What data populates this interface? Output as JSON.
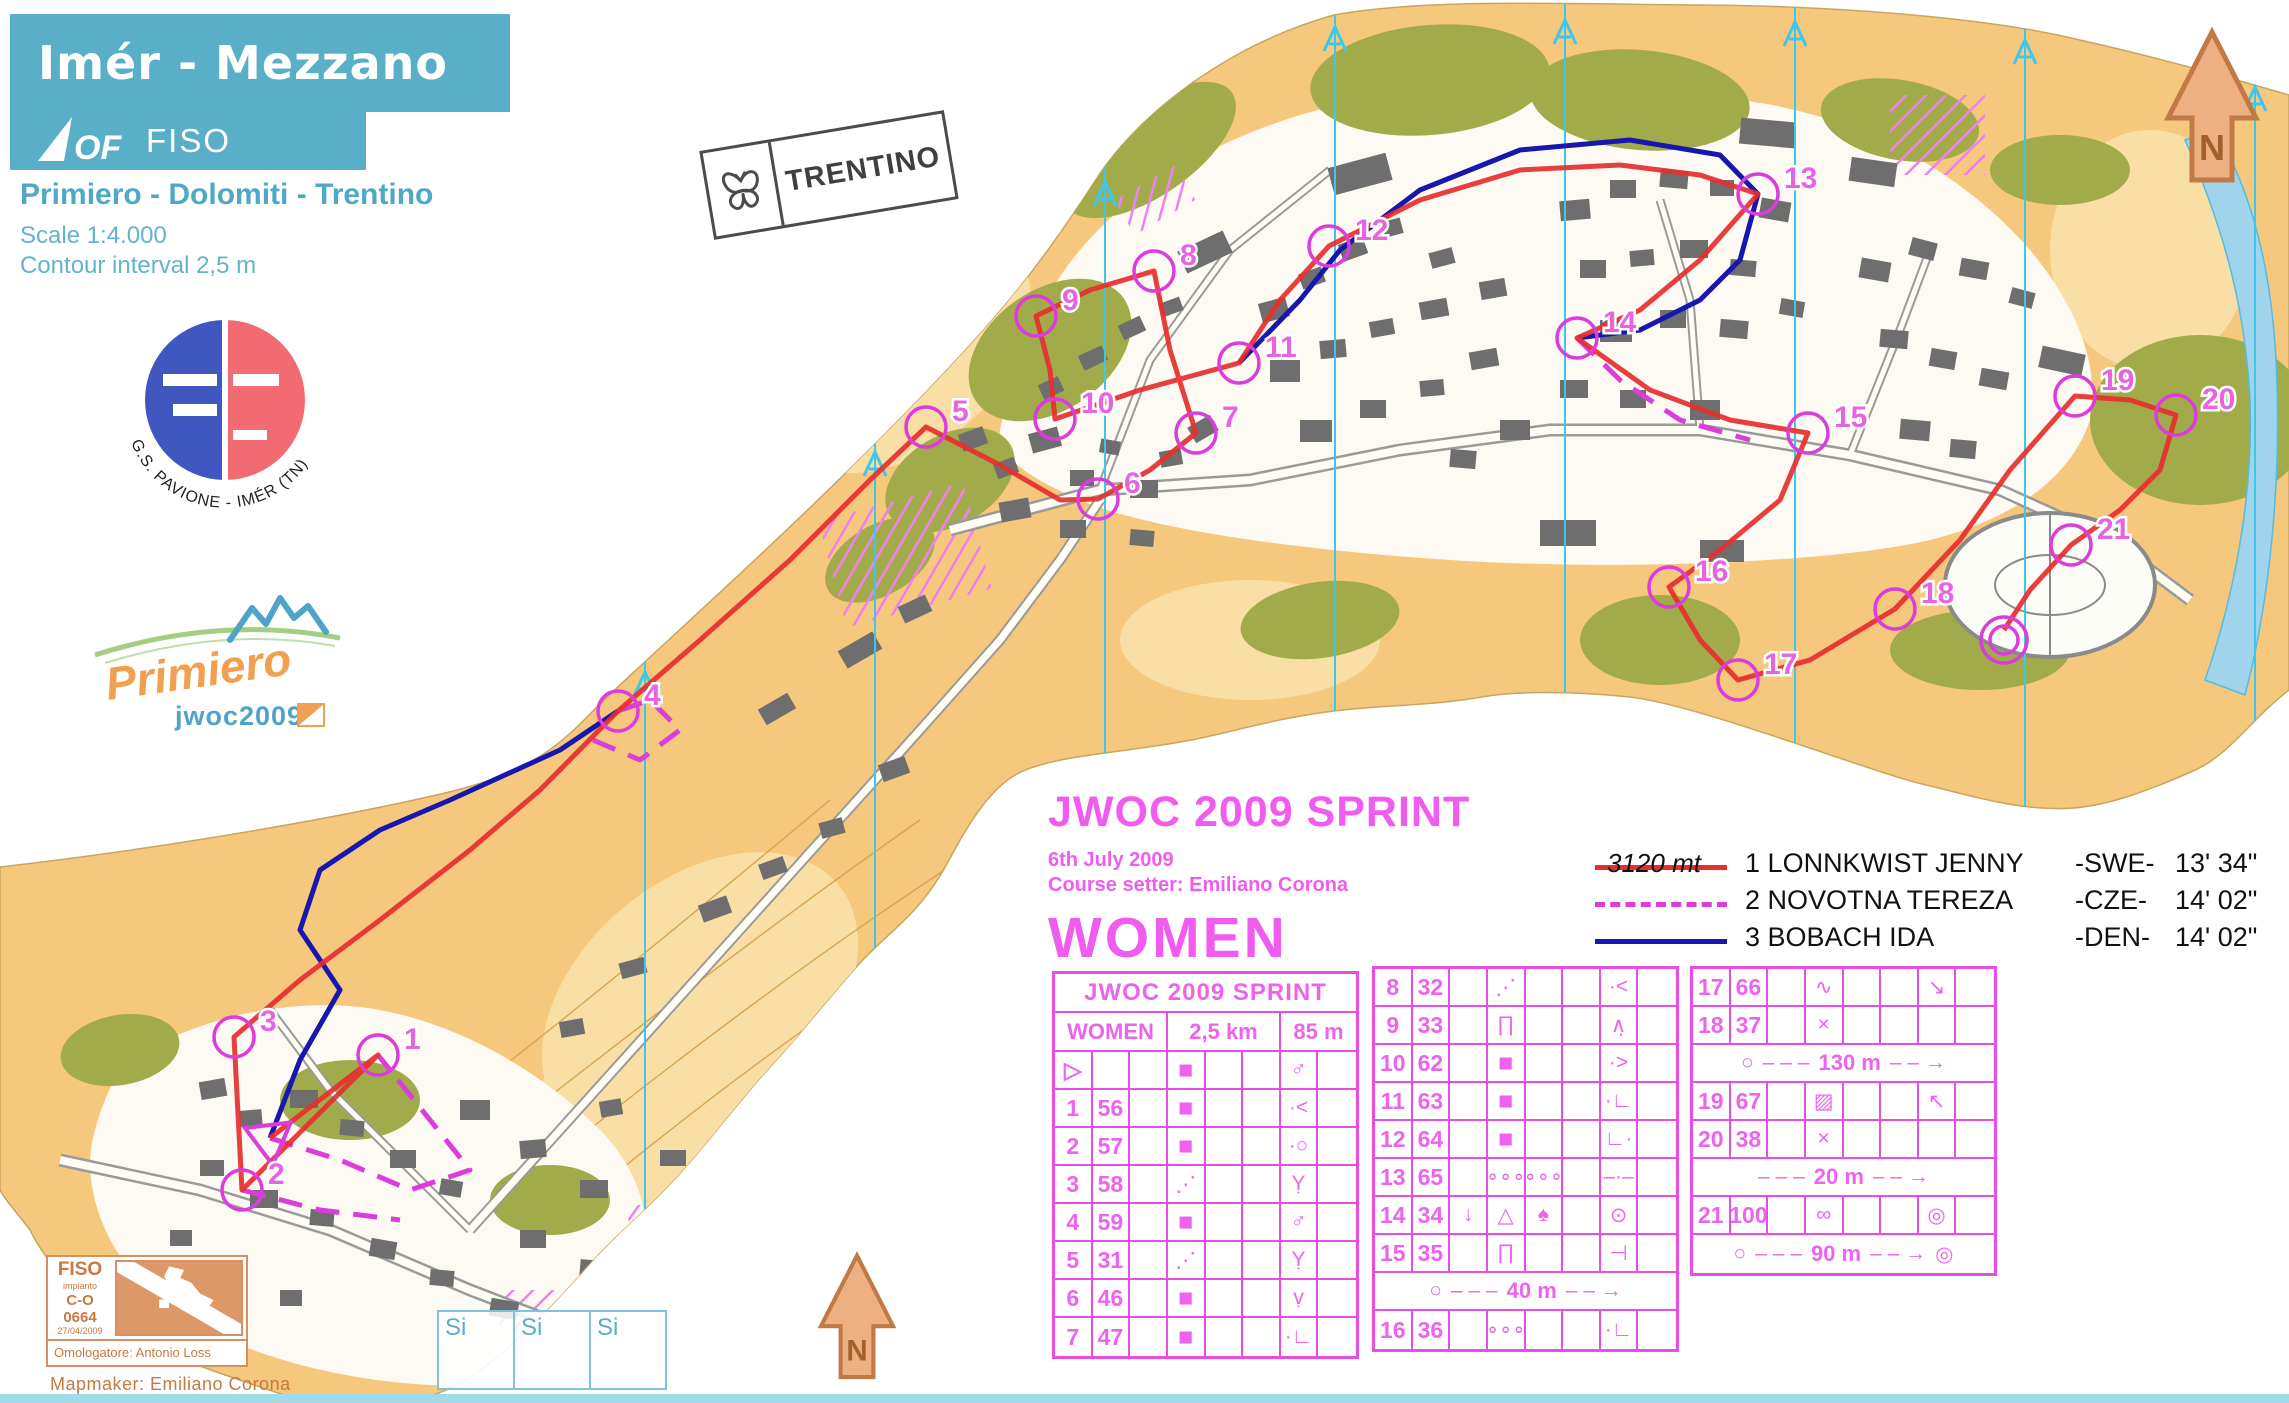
{
  "colors": {
    "header_teal": "#58AFC7",
    "event_pink": "#F05CF0",
    "card_magenta": "#E84DE8",
    "route_red": "#E62E2E",
    "route_magenta_dashed": "#DC3CDC",
    "route_blue": "#1717AE",
    "terrain_orange": "#F5C87D",
    "fiso_tan": "#C9783F"
  },
  "title_block": {
    "title": "Imér - Mezzano",
    "iof_text": "OF",
    "fiso_text": "FISO",
    "subtitle": "Primiero - Dolomiti - Trentino",
    "scale": "Scale 1:4.000",
    "contour": "Contour interval 2,5 m"
  },
  "logos": {
    "club_arc_text": "G.S. PAVIONE - IMÉR (TN)",
    "primiero_script": "Primiero",
    "jwoc_text": "jwoc2009",
    "trentino_text": "TRENTINO"
  },
  "event_block": {
    "title": "JWOC 2009 SPRINT",
    "date": "6th July 2009",
    "setter": "Course setter: Emiliano Corona",
    "category": "WOMEN"
  },
  "legend": {
    "distance": "3120 mt",
    "entries": [
      {
        "rank": "1",
        "name": "LONNKWIST JENNY",
        "country": "-SWE-",
        "time": "13' 34\""
      },
      {
        "rank": "2",
        "name": "NOVOTNA TEREZA",
        "country": "-CZE-",
        "time": "14' 02\""
      },
      {
        "rank": "3",
        "name": "BOBACH IDA",
        "country": "-DEN-",
        "time": "14' 02\""
      }
    ]
  },
  "control_card": {
    "title": "JWOC 2009 SPRINT",
    "header": {
      "category": "WOMEN",
      "length": "2,5 km",
      "climb": "85 m"
    },
    "panel1": [
      {
        "n": "▷",
        "code": "",
        "s": [
          "",
          "■",
          "",
          "",
          "♂",
          ""
        ]
      },
      {
        "n": "1",
        "code": "56",
        "s": [
          "",
          "■",
          "",
          "",
          "·<",
          ""
        ]
      },
      {
        "n": "2",
        "code": "57",
        "s": [
          "",
          "■",
          "",
          "",
          "·○",
          ""
        ]
      },
      {
        "n": "3",
        "code": "58",
        "s": [
          "",
          "⋰",
          "",
          "",
          "Ỵ",
          ""
        ]
      },
      {
        "n": "4",
        "code": "59",
        "s": [
          "",
          "■",
          "",
          "",
          "♂",
          ""
        ]
      },
      {
        "n": "5",
        "code": "31",
        "s": [
          "",
          "⋰",
          "",
          "",
          "Ỵ",
          ""
        ]
      },
      {
        "n": "6",
        "code": "46",
        "s": [
          "",
          "■",
          "",
          "",
          "ṿ",
          ""
        ]
      },
      {
        "n": "7",
        "code": "47",
        "s": [
          "",
          "■",
          "",
          "",
          "·∟",
          ""
        ]
      }
    ],
    "panel2": [
      {
        "n": "8",
        "code": "32",
        "s": [
          "",
          "⋰",
          "",
          "",
          "·<",
          ""
        ]
      },
      {
        "n": "9",
        "code": "33",
        "s": [
          "",
          "∏",
          "",
          "",
          "∧̣",
          ""
        ]
      },
      {
        "n": "10",
        "code": "62",
        "s": [
          "",
          "■",
          "",
          "",
          "·>",
          ""
        ]
      },
      {
        "n": "11",
        "code": "63",
        "s": [
          "",
          "■",
          "",
          "",
          "·∟",
          ""
        ]
      },
      {
        "n": "12",
        "code": "64",
        "s": [
          "",
          "■",
          "",
          "",
          "∟·",
          ""
        ]
      },
      {
        "n": "13",
        "code": "65",
        "s": [
          "",
          "∘∘∘",
          "∘∘∘",
          "",
          "–·–",
          ""
        ]
      },
      {
        "n": "14",
        "code": "34",
        "s": [
          "↓",
          "△",
          "♠",
          "",
          "⊙",
          ""
        ]
      },
      {
        "n": "15",
        "code": "35",
        "s": [
          "",
          "∏",
          "",
          "",
          "⊣",
          ""
        ]
      },
      {
        "special": true,
        "circle": true,
        "label": "40 m",
        "finish": false
      },
      {
        "n": "16",
        "code": "36",
        "s": [
          "",
          "∘∘∘",
          "",
          "",
          "·∟",
          ""
        ]
      }
    ],
    "panel3": [
      {
        "n": "17",
        "code": "66",
        "s": [
          "",
          "∿",
          "",
          "",
          "↘",
          ""
        ]
      },
      {
        "n": "18",
        "code": "37",
        "s": [
          "",
          "×",
          "",
          "",
          "",
          ""
        ]
      },
      {
        "special": true,
        "circle": true,
        "label": "130 m",
        "finish": false
      },
      {
        "n": "19",
        "code": "67",
        "s": [
          "",
          "▨",
          "",
          "",
          "↖",
          ""
        ]
      },
      {
        "n": "20",
        "code": "38",
        "s": [
          "",
          "×",
          "",
          "",
          "",
          ""
        ]
      },
      {
        "special": true,
        "circle": false,
        "label": "20 m",
        "finish": false
      },
      {
        "n": "21",
        "code": "100",
        "s": [
          "",
          "∞",
          "",
          "",
          "◎",
          ""
        ]
      },
      {
        "special": true,
        "circle": true,
        "label": "90 m",
        "finish": true
      }
    ]
  },
  "fiso_box": {
    "name": "FISO",
    "sub": "impianto",
    "code": "C-O",
    "number": "0664",
    "date": "27/04/2009",
    "approver": "Omologatore: Antonio Loss"
  },
  "mapmaker": "Mapmaker: Emiliano Corona",
  "si_boxes": [
    "Si",
    "Si",
    "Si"
  ],
  "north_label": "N",
  "map": {
    "controls": [
      {
        "n": "1",
        "x": 378,
        "y": 1055
      },
      {
        "n": "2",
        "x": 242,
        "y": 1190
      },
      {
        "n": "3",
        "x": 234,
        "y": 1037
      },
      {
        "n": "4",
        "x": 618,
        "y": 711
      },
      {
        "n": "5",
        "x": 926,
        "y": 427
      },
      {
        "n": "6",
        "x": 1098,
        "y": 499
      },
      {
        "n": "7",
        "x": 1196,
        "y": 433
      },
      {
        "n": "8",
        "x": 1154,
        "y": 271
      },
      {
        "n": "9",
        "x": 1036,
        "y": 316
      },
      {
        "n": "10",
        "x": 1055,
        "y": 419
      },
      {
        "n": "11",
        "x": 1239,
        "y": 363
      },
      {
        "n": "12",
        "x": 1329,
        "y": 246
      },
      {
        "n": "13",
        "x": 1758,
        "y": 194
      },
      {
        "n": "14",
        "x": 1577,
        "y": 338
      },
      {
        "n": "15",
        "x": 1808,
        "y": 433
      },
      {
        "n": "16",
        "x": 1669,
        "y": 587
      },
      {
        "n": "17",
        "x": 1738,
        "y": 680
      },
      {
        "n": "18",
        "x": 1895,
        "y": 609
      },
      {
        "n": "19",
        "x": 2075,
        "y": 396
      },
      {
        "n": "20",
        "x": 2176,
        "y": 415
      },
      {
        "n": "21",
        "x": 2071,
        "y": 545
      }
    ]
  }
}
